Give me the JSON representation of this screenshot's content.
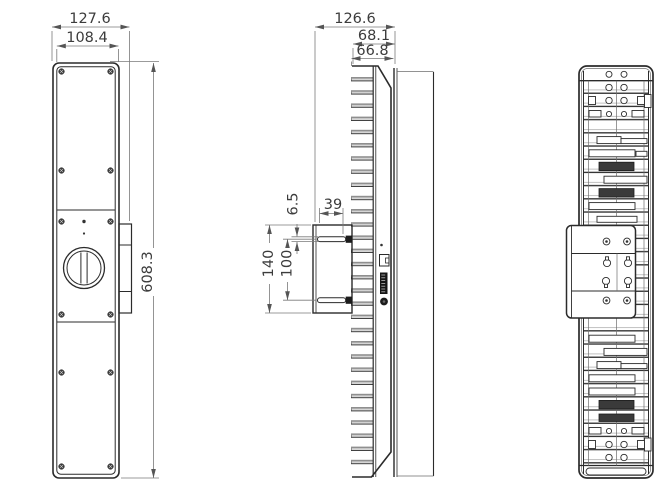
{
  "drawing": {
    "type": "technical-drawing-3-views",
    "views": {
      "front": {
        "dims": {
          "outer_width": "127.6",
          "panel_width": "108.4",
          "height": "608.3"
        }
      },
      "side": {
        "dims": {
          "overall_depth": "126.6",
          "heatsink_depth": "68.1",
          "body_depth": "66.8",
          "pin_thickness": "6.5",
          "bracket_depth": "39",
          "bracket_height": "140",
          "pin_spacing": "100"
        }
      }
    },
    "colors": {
      "background": "#ffffff",
      "object_line": "#2b2b2b",
      "dimension_line": "#7a7a7a",
      "text": "#3c3c3c",
      "dark_fill": "#1c1c1c",
      "fin_fill": "#d6d6d6"
    }
  }
}
